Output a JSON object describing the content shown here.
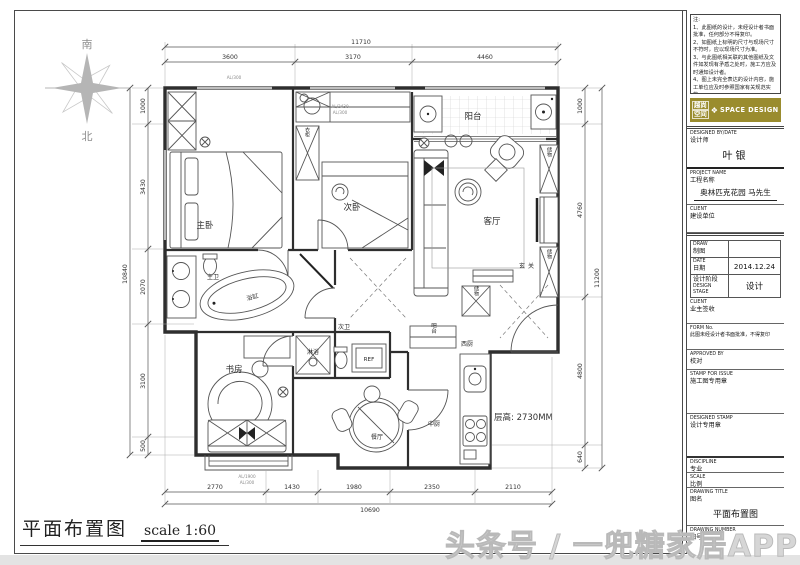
{
  "compass": {
    "south": "南",
    "north": "北"
  },
  "plan": {
    "labels": {
      "master_bedroom": "主卧",
      "second_bedroom": "次卧",
      "balcony": "阳台",
      "living_room": "客厅",
      "foyer": "玄关",
      "master_bath": "主卫",
      "bathtub": "浴缸",
      "study": "书房",
      "shower": "淋浴",
      "second_bath": "次卫",
      "dining": "餐厅",
      "kitchen": "中厨",
      "west_kitchen": "西厨",
      "bar": "吧台",
      "fridge": "REF",
      "wardrobe": "衣柜",
      "storage": "储物",
      "ceiling_height": "层高: 2730MM"
    },
    "annotations": {
      "top_wall": "AL/300",
      "balcony_a": "AL/2430",
      "balcony_b": "AL/300",
      "study_a": "AL/1900",
      "study_b": "AL/300"
    },
    "dims": {
      "top": {
        "overall": "11710",
        "seg1": "3600",
        "seg2": "3170",
        "seg3": "4460"
      },
      "left": {
        "overall": "10840",
        "seg1": "1000",
        "seg2": "3430",
        "seg3": "2070",
        "seg4": "3100",
        "seg5": "500"
      },
      "right": {
        "overall": "11200",
        "seg1": "1000",
        "seg2": "4760",
        "seg3": "4800",
        "seg4": "640"
      },
      "bottom": {
        "overall": "10690",
        "seg1": "2770",
        "seg2": "1430",
        "seg3": "1980",
        "seg4": "2350",
        "seg5": "2110"
      }
    }
  },
  "footer": {
    "title": "平面布置图",
    "scale": "scale 1:60"
  },
  "watermark": "头条号 / 一兜糖家居APP",
  "titleblock": {
    "notes": {
      "heading": "注:",
      "n1": "1、此图纸的设计，未经设计者书面批准，任何部分不得复印。",
      "n2": "2、如图纸上标明的尺寸与现场尺寸不符时，应以现场尺寸为准。",
      "n3": "3、与此图纸相关联的其他图纸及文件如发现有矛盾之处时，施工方应及时通知设计者。",
      "n4": "4、图上未完全表达的设计内容，施工单位应及时参照国家有关规范实施。"
    },
    "logo": {
      "cn1": "越尚",
      "cn2": "空间",
      "en": "SPACE DESIGN",
      "diamond": "❖",
      "color": "#9a8c2e"
    },
    "designer": {
      "en": "DESIGNED BY/DATE",
      "cn": "设计师",
      "value": "叶银"
    },
    "project": {
      "en": "PROJECT NAME",
      "cn": "工程名称",
      "value": "奥林匹克花园 马先生"
    },
    "client1": {
      "en": "CLIENT",
      "cn": "建设单位"
    },
    "table": {
      "draw": {
        "en": "DRAW",
        "cn": "制图",
        "value": ""
      },
      "date": {
        "en": "DATE",
        "cn": "日期",
        "value": "2014.12.24"
      },
      "stage": {
        "cn": "设计阶段",
        "en": "DESIGN STAGE",
        "value": "设计"
      }
    },
    "client2": {
      "en": "CLIENT",
      "cn": "业主签收"
    },
    "form": {
      "en": "FORM No.",
      "cn": "此图未经设计者书面批准，不得复印"
    },
    "approved": {
      "en": "APPROVED BY",
      "cn": "校对"
    },
    "stamp_issue": {
      "en": "STAMP FOR ISSUE",
      "cn": "施工图专用章"
    },
    "stamp_design": {
      "en": "DESIGNED STAMP",
      "cn": "设计专用章"
    },
    "discipline": {
      "en": "DISCIPLINE",
      "cn": "专业"
    },
    "scale": {
      "en": "SCALE",
      "cn": "比例"
    },
    "drawing_title": {
      "en": "DRAWING TITLE",
      "cn": "图名",
      "value": "平面布置图"
    },
    "drawing_number": {
      "en": "DRAWING NUMBER",
      "cn": "图号",
      "value": "1"
    }
  }
}
